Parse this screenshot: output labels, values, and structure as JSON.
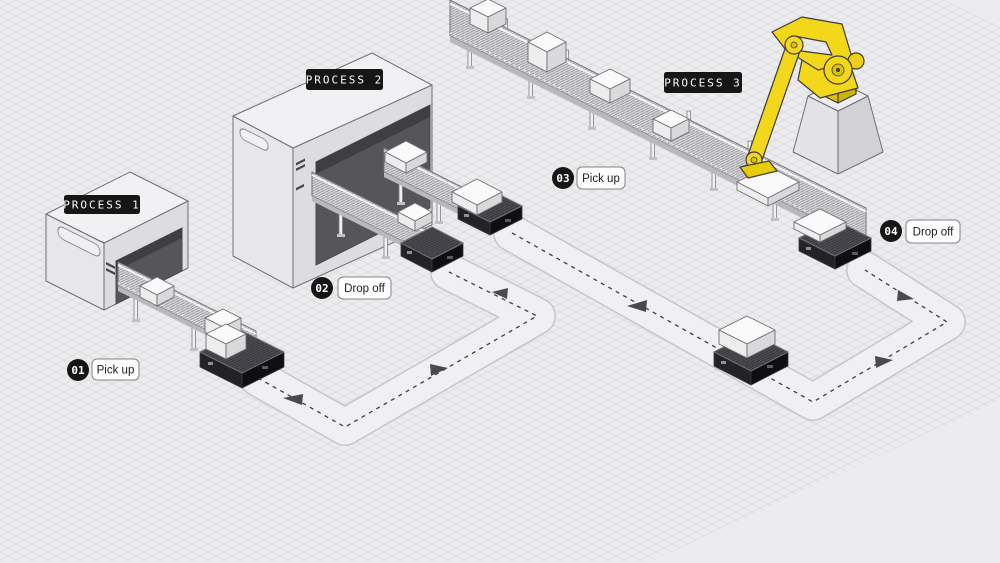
{
  "diagram": {
    "title_hidden": "",
    "processes": [
      {
        "id": "process-1",
        "label": "PROCESS 1"
      },
      {
        "id": "process-2",
        "label": "PROCESS 2"
      },
      {
        "id": "process-3",
        "label": "PROCESS 3"
      }
    ],
    "stations": [
      {
        "num": "01",
        "action": "Pick up"
      },
      {
        "num": "02",
        "action": "Drop off"
      },
      {
        "num": "03",
        "action": "Pick up"
      },
      {
        "num": "04",
        "action": "Drop off"
      }
    ],
    "colors": {
      "background": "#ececee",
      "grid_line": "#d9d9de",
      "path_band": "#f0f0f2",
      "path_edge": "#c6c6c9",
      "arrow": "#4a4a4d",
      "label_bg": "#161616",
      "label_text": "#ffffff",
      "pill_bg": "#fdfdfd",
      "pill_border": "#85858a",
      "machine_top": "#f1f1f3",
      "machine_left": "#e7e7e9",
      "machine_right": "#dddde0",
      "machine_door": "#55555a",
      "belt": "#d7d7da",
      "agv_dark": "#1c1c1f",
      "robot_yellow": "#f3d71a",
      "robot_yellow_shade": "#d8be05"
    }
  }
}
